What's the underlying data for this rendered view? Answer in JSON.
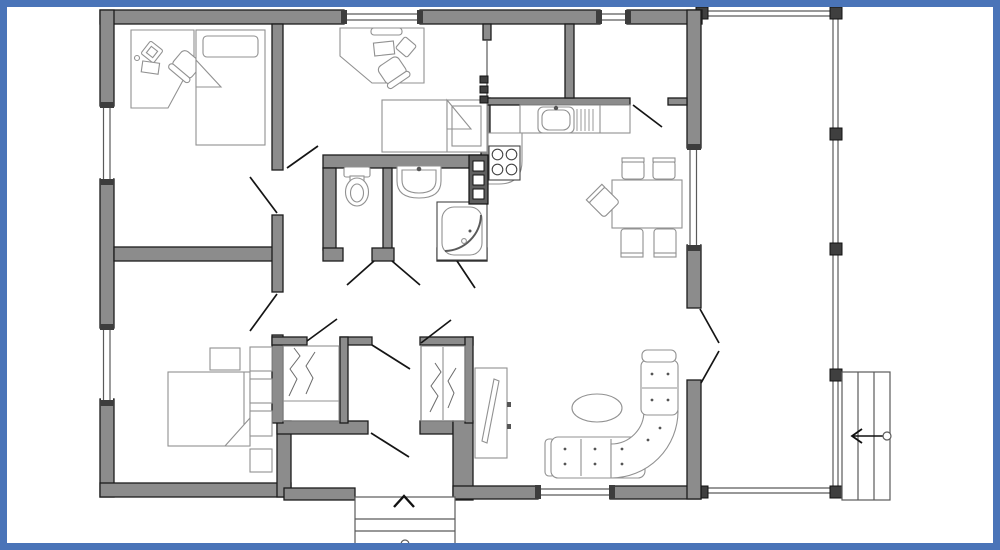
{
  "meta": {
    "type": "floor-plan",
    "description": "Single-storey house floor plan with side porch and stairs"
  },
  "plan": {
    "colors": {
      "frame_blue": "#4a74b8",
      "wall_fill": "#8c8c8c",
      "wall_outline": "#1c1c1c",
      "furniture_stroke": "#919191",
      "thin_line": "#5a5a5a",
      "door_line": "#151515",
      "fixture_dark": "#5f5f5f",
      "background": "#ffffff"
    },
    "rooms": [
      {
        "name": "office-bedroom-top-left",
        "furniture": [
          "corner-desk",
          "monitor",
          "keyboard",
          "desk-chair",
          "single-bed"
        ]
      },
      {
        "name": "kids-room-top-middle",
        "furniture": [
          "corner-desk",
          "monitor",
          "keyboard",
          "desk-chair",
          "single-bed",
          "radiator"
        ]
      },
      {
        "name": "storage-room-top-right",
        "furniture": []
      },
      {
        "name": "kitchen-dining",
        "furniture": [
          "kitchen-counter",
          "sink-with-drainer",
          "stove-four-burners",
          "dining-table",
          "dining-chairs-x5"
        ]
      },
      {
        "name": "wc",
        "furniture": [
          "toilet"
        ]
      },
      {
        "name": "bathroom",
        "furniture": [
          "washbasin",
          "shower-cabin",
          "water-heater-unit"
        ]
      },
      {
        "name": "hallway",
        "furniture": []
      },
      {
        "name": "master-bedroom",
        "furniture": [
          "double-bed",
          "shelf-blocks-x4",
          "stool"
        ]
      },
      {
        "name": "wardrobe-closets",
        "furniture": [
          "hanging-clothes",
          "hanging-clothes"
        ]
      },
      {
        "name": "entry-vestibule",
        "furniture": [
          "entry-steps"
        ]
      },
      {
        "name": "living-room",
        "furniture": [
          "corner-sofa",
          "oval-coffee-table",
          "tv-cabinet"
        ]
      },
      {
        "name": "porch-terrace",
        "furniture": [
          "posts",
          "side-stairs"
        ]
      }
    ],
    "symbols": {
      "entry_direction_arrow": "up",
      "stairs_direction_arrow": "left",
      "windows_count": 6,
      "door_swings_count": 13
    }
  }
}
